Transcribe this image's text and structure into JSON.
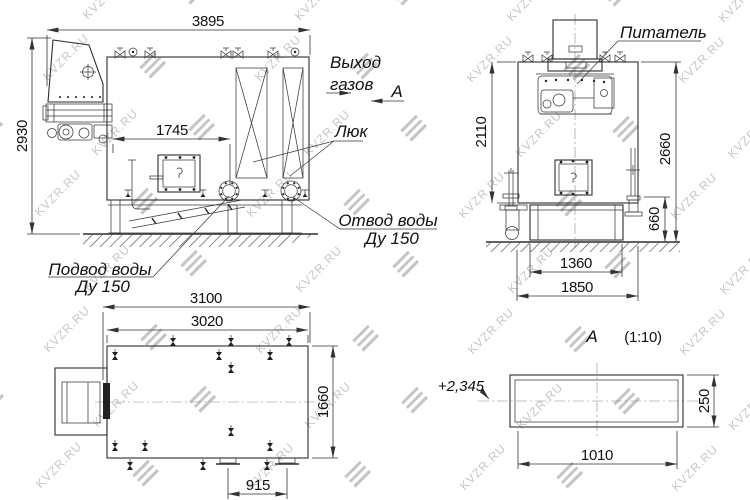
{
  "watermark": {
    "text": "KVZR.RU"
  },
  "front_view": {
    "dim_width": "3895",
    "dim_height": "2930",
    "dim_door": "1745",
    "label_gas_1": "Выход",
    "label_gas_2": "газов",
    "label_view": "А",
    "label_hatch": "Люк",
    "label_outlet_1": "Отвод воды",
    "label_outlet_2": "Ду 150",
    "label_supply_1": "Подвод воды",
    "label_supply_2": "Ду 150"
  },
  "side_view": {
    "label_feeder": "Питатель",
    "dim_body_height": "2110",
    "dim_total_height": "2660",
    "dim_base_height": "660",
    "dim_base_width": "1360",
    "dim_width": "1850"
  },
  "plan_view": {
    "dim_overall": "3100",
    "dim_body": "3020",
    "dim_depth": "1660",
    "dim_flanges": "915"
  },
  "detail_view": {
    "title_letter": "А",
    "title_scale": "(1:10)",
    "elevation": "+2,345",
    "dim_width": "1010",
    "dim_height": "250"
  }
}
